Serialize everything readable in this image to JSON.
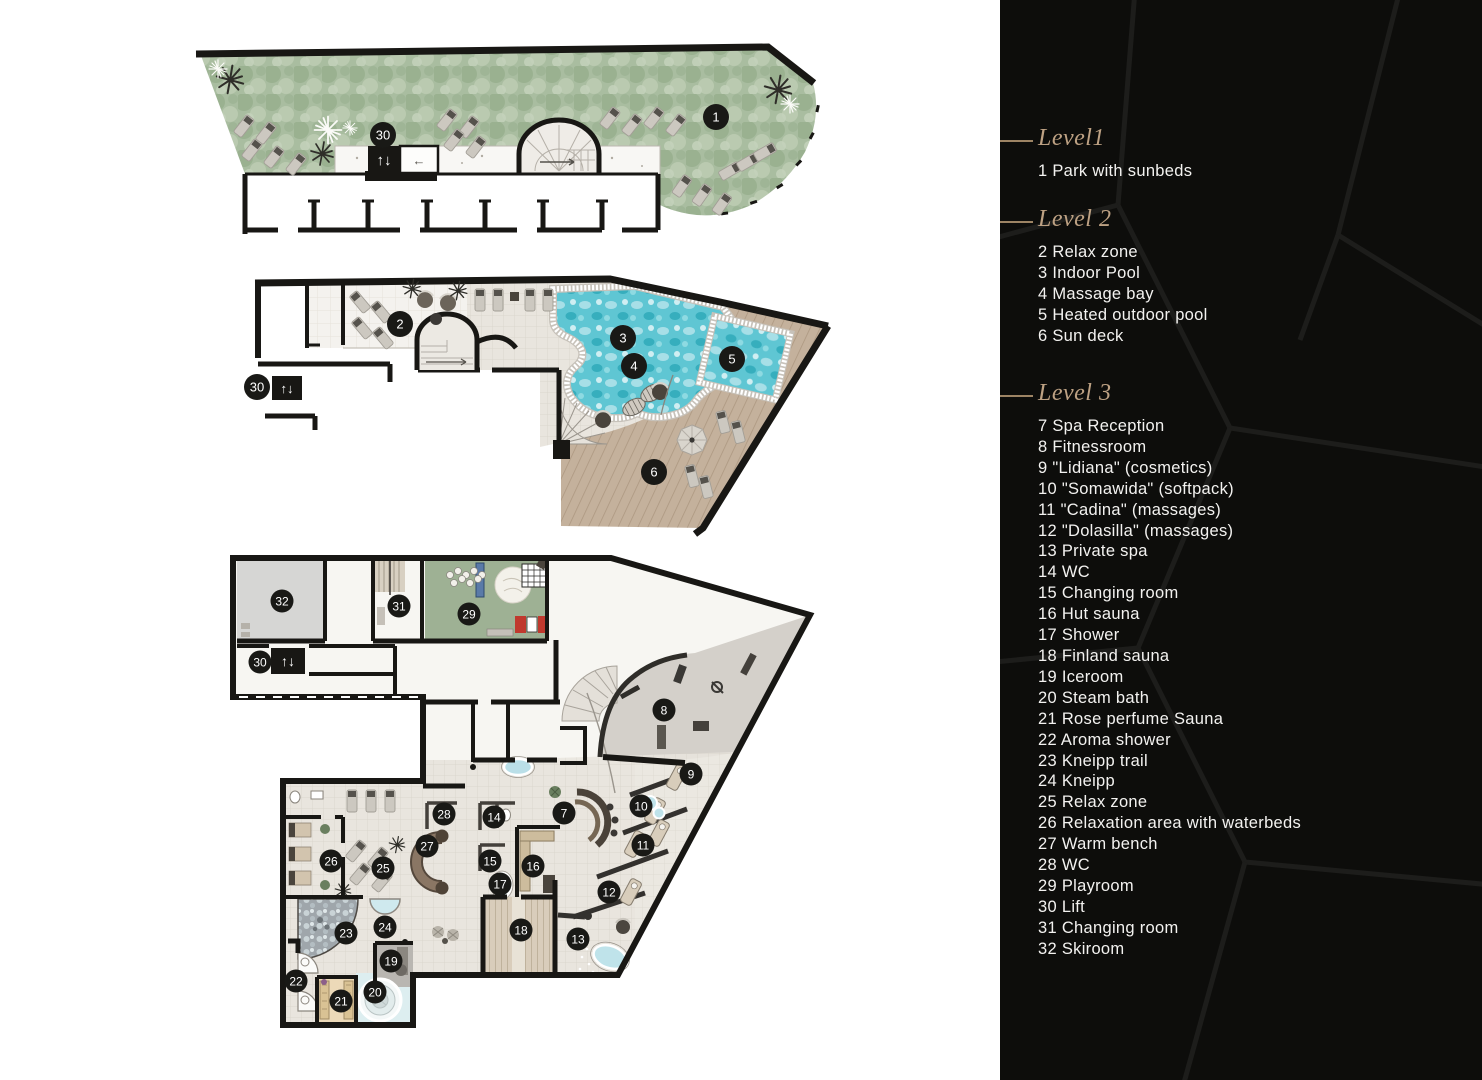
{
  "legend": {
    "panel_bg": "#0d0d0b",
    "heading_color": "#bda183",
    "text_color": "#f3f2f0",
    "sections": [
      {
        "heading": "Level1",
        "items": [
          "1 Park with sunbeds"
        ]
      },
      {
        "heading": "Level 2",
        "items": [
          "2 Relax zone",
          "3 Indoor Pool",
          "4 Massage bay",
          "5 Heated outdoor pool",
          "6 Sun deck"
        ]
      },
      {
        "heading": "Level 3",
        "items": [
          "7 Spa Reception",
          "8 Fitnessroom",
          "9 \"Lidiana\" (cosmetics)",
          "10 \"Somawida\" (softpack)",
          "11 \"Cadina\" (massages)",
          "12 \"Dolasilla\" (massages)",
          "13 Private spa",
          "14 WC",
          "15 Changing room",
          "16 Hut sauna",
          "17 Shower",
          "18 Finland sauna",
          "19 Iceroom",
          "20 Steam bath",
          "21 Rose perfume Sauna",
          "22 Aroma shower",
          "23 Kneipp trail",
          "24 Kneipp",
          "25 Relax zone",
          "26 Relaxation area with waterbeds",
          "27 Warm bench",
          "28 WC",
          "29 Playroom",
          "30 Lift",
          "31 Changing room",
          "32 Skiroom"
        ]
      }
    ]
  },
  "icons": {
    "lift_arrows": "↑↓",
    "arrow_left": "←",
    "arrow_right": "→"
  },
  "colors": {
    "walls": "#181714",
    "marker": "#191916",
    "park_green": "#a9bda0",
    "pool_water": "#5fc6d3",
    "deck_wood": "#c4b19c",
    "floor_tile": "#e9e5de",
    "fitness_floor": "#d4d0ca",
    "playroom_green": "#9eb194",
    "skiroom_grey": "#d6d6d4"
  },
  "plans": [
    {
      "id": "level1",
      "label": "Level 1 floor plan",
      "r": 13,
      "markers": [
        {
          "n": "30",
          "x": 201,
          "y": 97
        },
        {
          "n": "1",
          "x": 534,
          "y": 79
        }
      ]
    },
    {
      "id": "level2",
      "label": "Level 2 floor plan",
      "r": 13,
      "markers": [
        {
          "n": "2",
          "x": 160,
          "y": 52
        },
        {
          "n": "3",
          "x": 383,
          "y": 66
        },
        {
          "n": "4",
          "x": 394,
          "y": 94
        },
        {
          "n": "5",
          "x": 492,
          "y": 87
        },
        {
          "n": "6",
          "x": 414,
          "y": 200
        },
        {
          "n": "30",
          "x": 17,
          "y": 115
        }
      ]
    },
    {
      "id": "level3",
      "label": "Level 3 floor plan",
      "r": 11.5,
      "markers": [
        {
          "n": "7",
          "x": 339,
          "y": 268
        },
        {
          "n": "8",
          "x": 439,
          "y": 165
        },
        {
          "n": "9",
          "x": 466,
          "y": 229
        },
        {
          "n": "10",
          "x": 416,
          "y": 261
        },
        {
          "n": "11",
          "x": 418,
          "y": 300
        },
        {
          "n": "12",
          "x": 384,
          "y": 347
        },
        {
          "n": "13",
          "x": 353,
          "y": 394
        },
        {
          "n": "14",
          "x": 269,
          "y": 272
        },
        {
          "n": "15",
          "x": 265,
          "y": 316
        },
        {
          "n": "16",
          "x": 308,
          "y": 321
        },
        {
          "n": "17",
          "x": 275,
          "y": 339
        },
        {
          "n": "18",
          "x": 296,
          "y": 385
        },
        {
          "n": "19",
          "x": 166,
          "y": 416
        },
        {
          "n": "20",
          "x": 150,
          "y": 447
        },
        {
          "n": "21",
          "x": 116,
          "y": 456
        },
        {
          "n": "22",
          "x": 71,
          "y": 436
        },
        {
          "n": "23",
          "x": 121,
          "y": 388
        },
        {
          "n": "24",
          "x": 160,
          "y": 382
        },
        {
          "n": "25",
          "x": 158,
          "y": 323
        },
        {
          "n": "26",
          "x": 106,
          "y": 316
        },
        {
          "n": "27",
          "x": 202,
          "y": 301
        },
        {
          "n": "28",
          "x": 219,
          "y": 269
        },
        {
          "n": "29",
          "x": 244,
          "y": 69
        },
        {
          "n": "30",
          "x": 35,
          "y": 117
        },
        {
          "n": "31",
          "x": 174,
          "y": 61
        },
        {
          "n": "32",
          "x": 57,
          "y": 56
        }
      ]
    }
  ]
}
